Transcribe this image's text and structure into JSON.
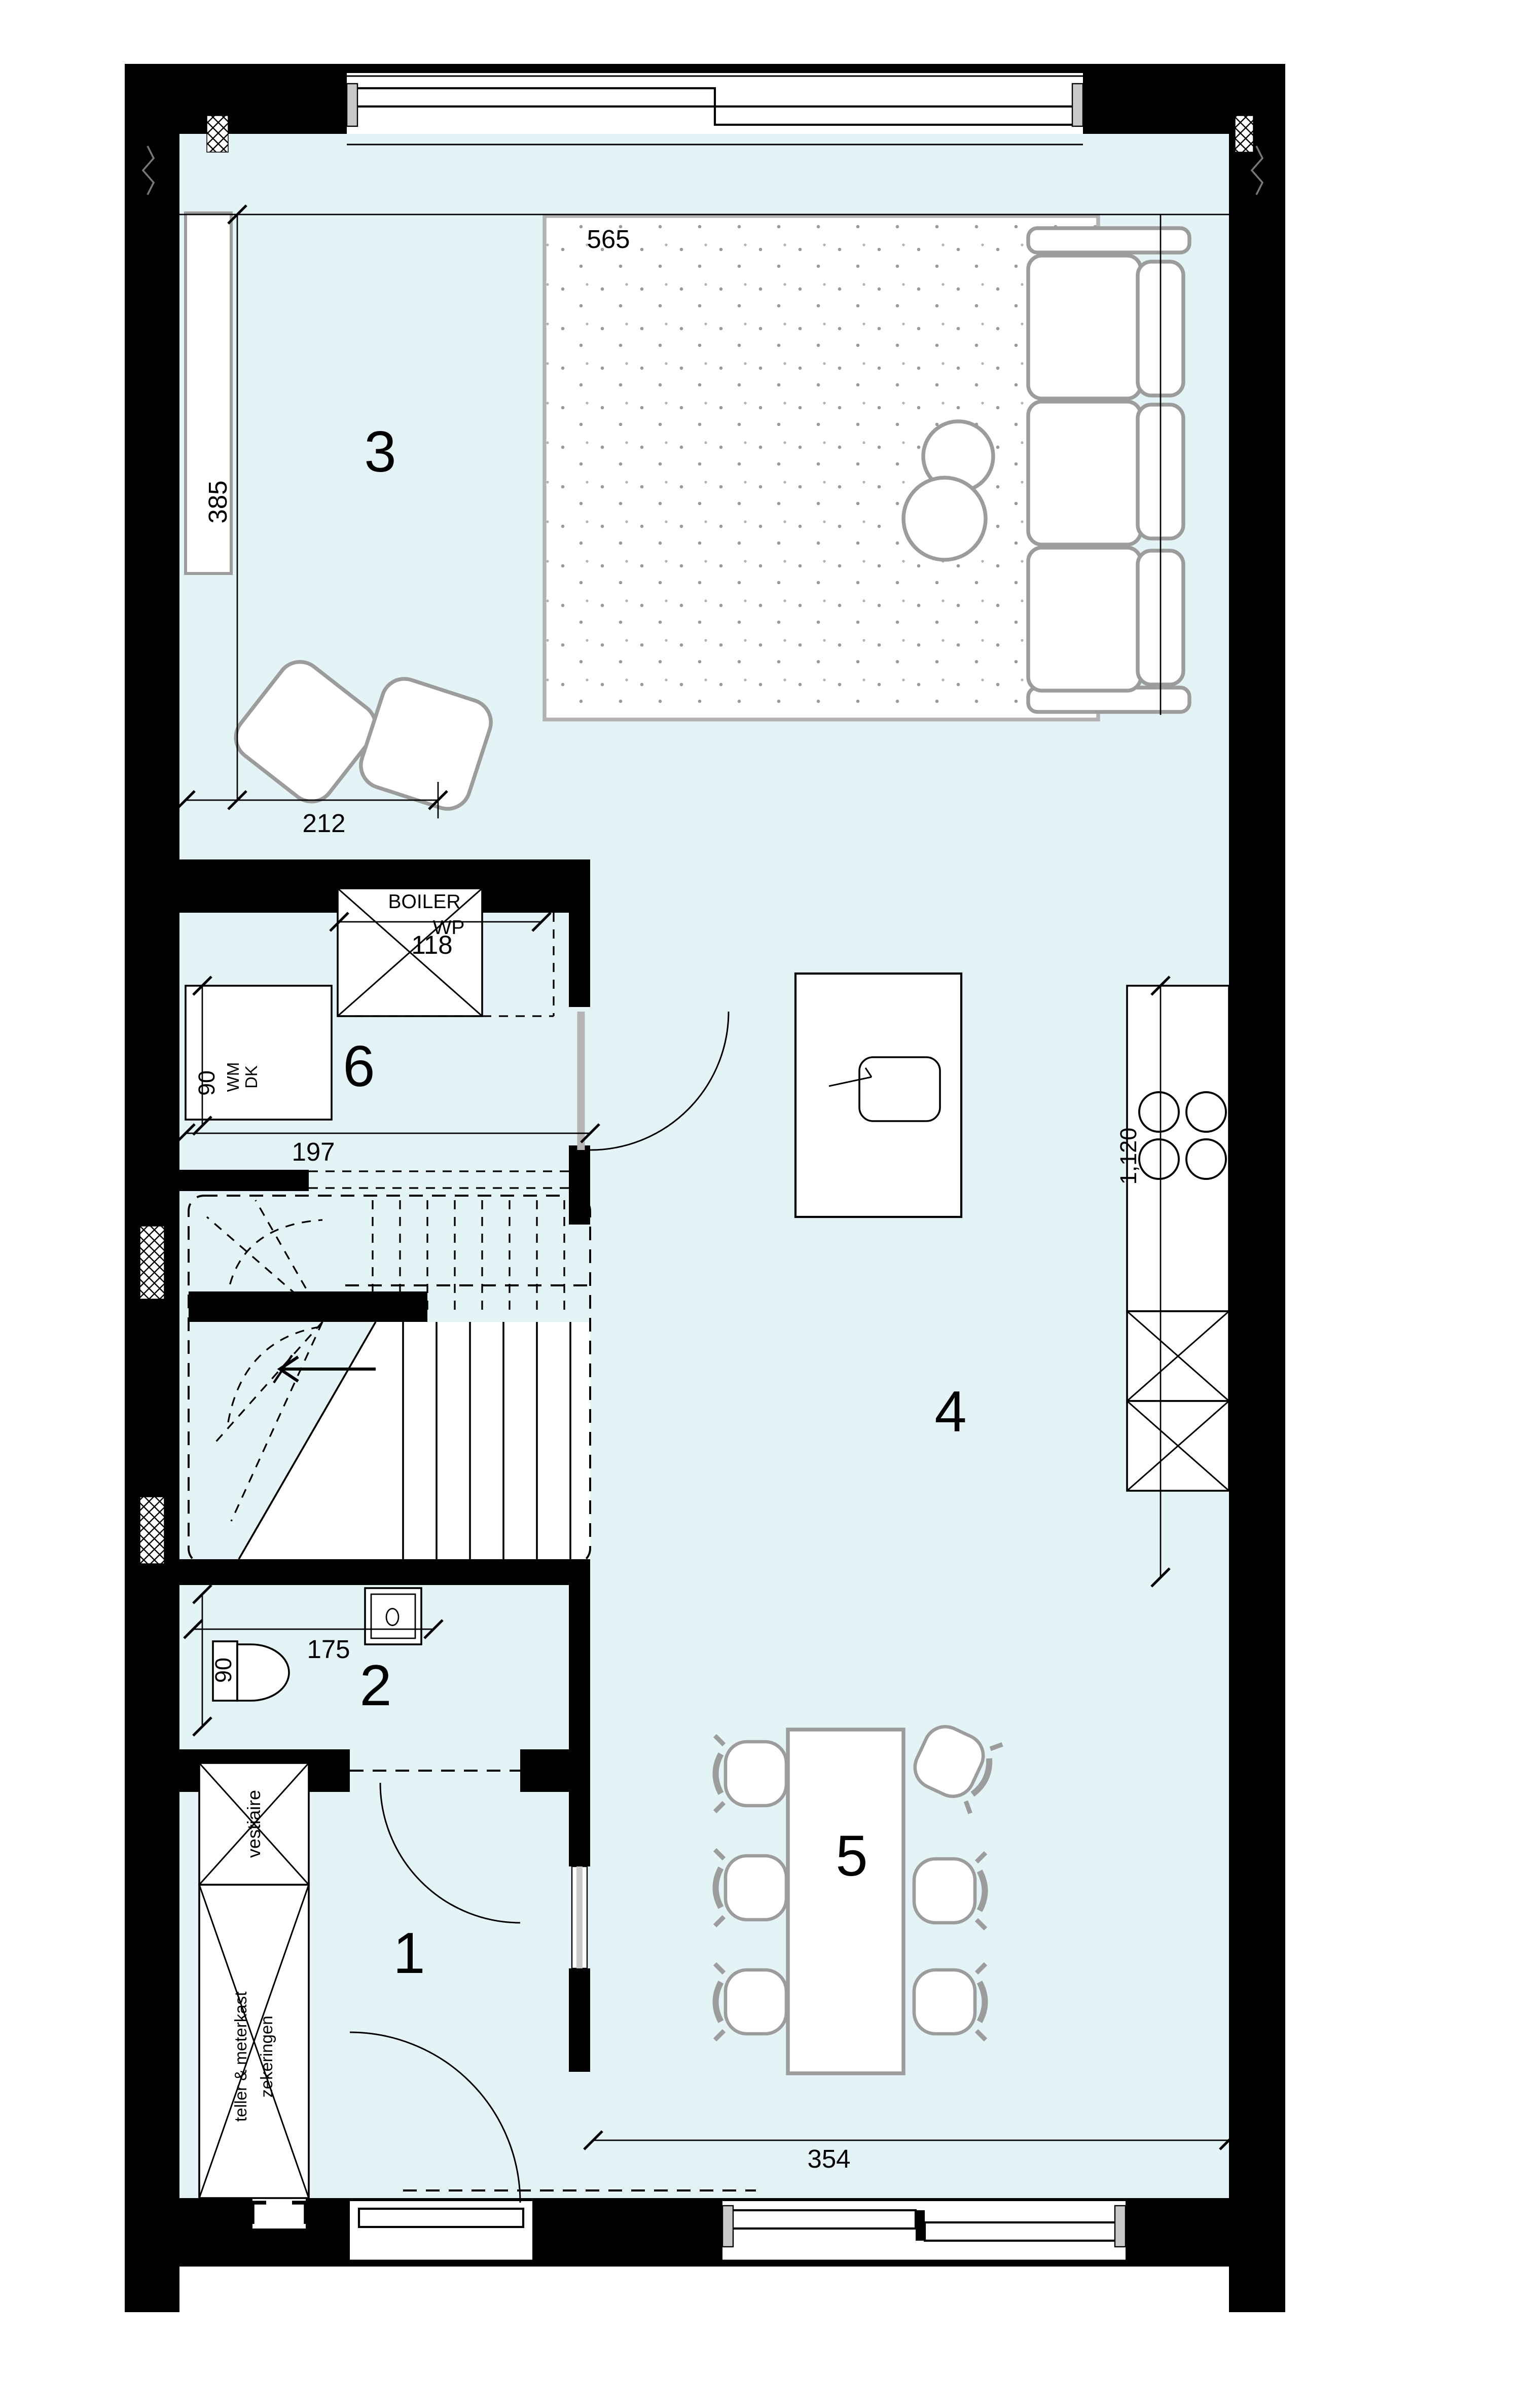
{
  "rooms": {
    "r1": "1",
    "r2": "2",
    "r3": "3",
    "r4": "4",
    "r5": "5",
    "r6": "6"
  },
  "dimensions": {
    "top_width": "565",
    "left_height": "385",
    "living": "212",
    "boiler_width": "118",
    "utility_width": "197",
    "utility_depth": "90",
    "kitchen_counter": "1,120",
    "toilet_width": "175",
    "toilet_depth": "90",
    "bottom_width": "354"
  },
  "labels": {
    "boiler": "BOILER",
    "heat_pump": "WP",
    "dryer": "DK",
    "washing_machine": "WM",
    "wardrobe": "vestiaire",
    "meter_cabinet_line1": "teller & meterkast",
    "meter_cabinet_line2": "zekeringen"
  },
  "colors": {
    "floor": "#e4f3f6",
    "wall": "#000000",
    "furniture_outline": "#9c9c9c",
    "glass": "#c9c9c9"
  }
}
